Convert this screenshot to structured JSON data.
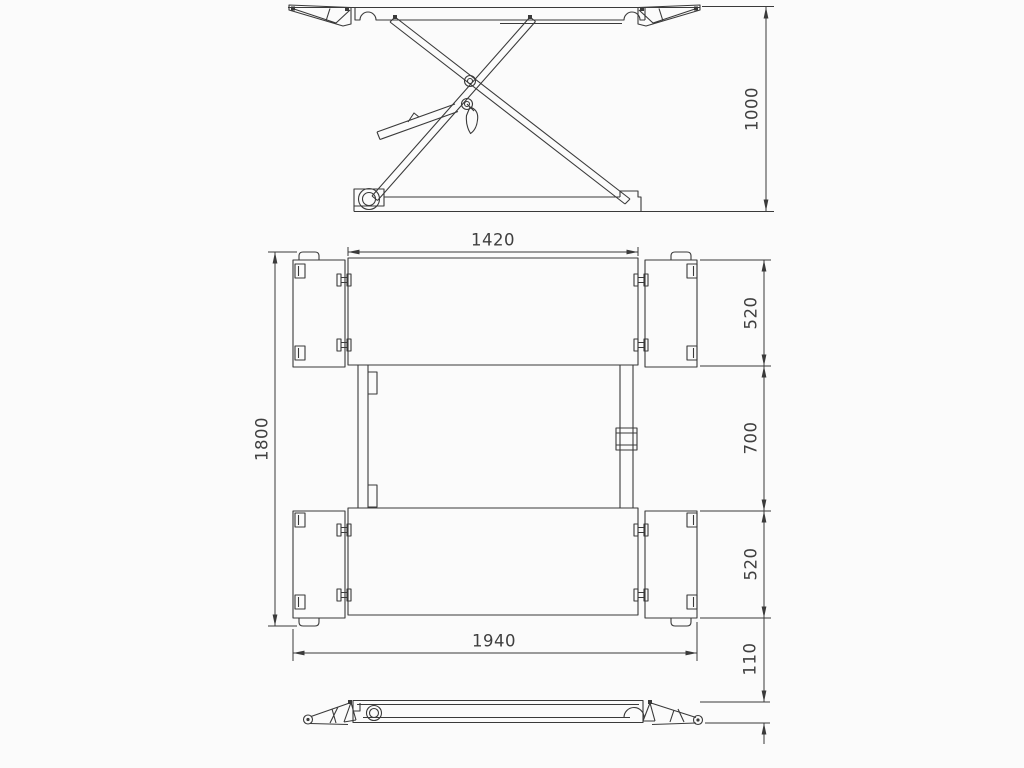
{
  "page": {
    "background": "#fbfbfb"
  },
  "drawing": {
    "stroke_color": "#3a3a3a",
    "text_color": "#3f3f3f",
    "dims": {
      "raised_height": "1000",
      "platform_length": "1420",
      "overall_width": "1800",
      "platform_side_top": "520",
      "center_gap": "700",
      "platform_side_bottom": "520",
      "overall_length": "1940",
      "lowered_height": "110"
    }
  }
}
